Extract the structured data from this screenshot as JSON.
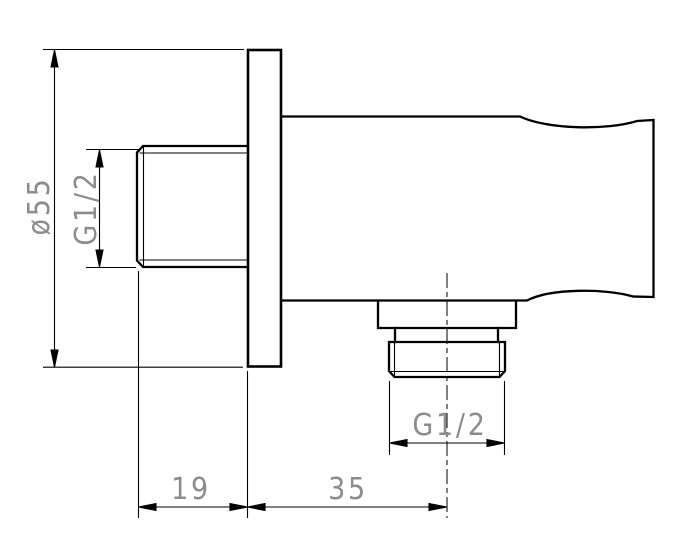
{
  "drawing": {
    "description": "technical side-view drawing of a wall-mounted shower outlet elbow with round wall plate, inlet thread at left and outlet thread at bottom",
    "colors": {
      "background": "#ffffff",
      "line": "#000000",
      "dimension_text": "#8c8c8c"
    },
    "dimensions": [
      {
        "id": "plate-diameter",
        "label": "ø55",
        "orientation": "vertical-rotated"
      },
      {
        "id": "inlet-thread-size",
        "label": "G1/2",
        "orientation": "vertical-rotated"
      },
      {
        "id": "inlet-projection",
        "label": "19",
        "orientation": "horizontal"
      },
      {
        "id": "plate-to-outlet-axis",
        "label": "35",
        "orientation": "horizontal"
      },
      {
        "id": "outlet-thread-size",
        "label": "G1/2",
        "orientation": "horizontal"
      }
    ]
  }
}
